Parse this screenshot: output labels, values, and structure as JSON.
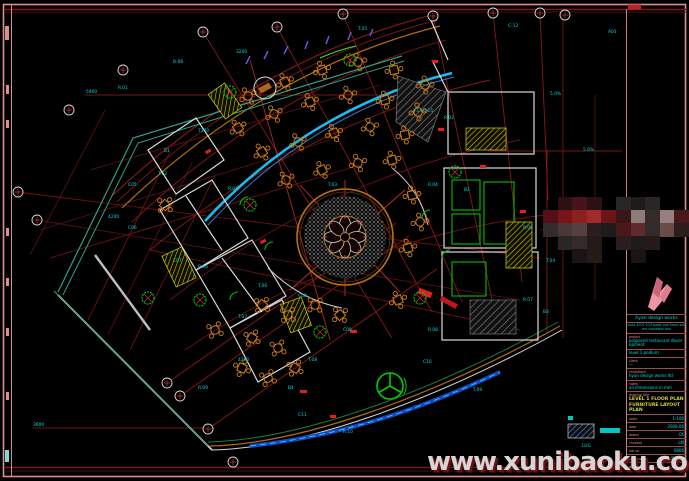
{
  "colors": {
    "frame": "#d98f8f",
    "frame_dark": "#7a1a1a",
    "grid_red": "#8a1818",
    "grid_bright": "#c03030",
    "cyan_text": "#00dcdc",
    "arc_cyan": "#18bdf0",
    "teal": "#2fa08a",
    "furniture": "#cf7f16",
    "wall_white": "#d8d8d8",
    "green": "#00c000",
    "stair_yellow": "#d8d800",
    "blue_band": "#1546c8",
    "logo_pink": "#ef94a2"
  },
  "watermark": {
    "text": "www.xunibaoku.com"
  },
  "title_block": {
    "caption": "hyan design works",
    "address": "suite 2001 20/f tower one times square causeway bay",
    "rows": [
      {
        "label": "project",
        "value": "proposed restaurant development"
      },
      {
        "label": "",
        "value": "level 1 podium"
      },
      {
        "label": "client",
        "value": "—"
      },
      {
        "label": "consultant",
        "value": "hyan design works ltd"
      },
      {
        "label": "notes",
        "value": "all dimensions in mm"
      }
    ],
    "title_label": "drawing title",
    "drawing_title": "LEVEL 1 FLOOR PLAN FURNITURE LAYOUT PLAN",
    "fields": [
      {
        "label": "scale",
        "value": "1:100"
      },
      {
        "label": "date",
        "value": "2008.06"
      },
      {
        "label": "drawn",
        "value": "CK"
      },
      {
        "label": "checked",
        "value": "LM"
      },
      {
        "label": "job no.",
        "value": "0806"
      },
      {
        "label": "drawing no.",
        "value": "ID-101"
      },
      {
        "label": "rev",
        "value": "A"
      }
    ]
  },
  "legend": {
    "swatch_label": "P.01"
  },
  "plan": {
    "labels": [
      {
        "t": "5400",
        "x": 86,
        "y": 93
      },
      {
        "t": "3600",
        "x": 33,
        "y": 426
      },
      {
        "t": "T.05",
        "x": 358,
        "y": 30
      },
      {
        "t": "C-12",
        "x": 508,
        "y": 27
      },
      {
        "t": "A01",
        "x": 608,
        "y": 33
      },
      {
        "t": "3200",
        "x": 236,
        "y": 53
      },
      {
        "t": "B-06",
        "x": 173,
        "y": 63
      },
      {
        "t": "R.01",
        "x": 118,
        "y": 89
      },
      {
        "t": "5.0%",
        "x": 550,
        "y": 95
      },
      {
        "t": "F.L+0.15",
        "x": 414,
        "y": 112
      },
      {
        "t": "R.02",
        "x": 444,
        "y": 119
      },
      {
        "t": "7200",
        "x": 198,
        "y": 132
      },
      {
        "t": "B1",
        "x": 164,
        "y": 152
      },
      {
        "t": "5.0%",
        "x": 583,
        "y": 151
      },
      {
        "t": "T.02",
        "x": 158,
        "y": 175
      },
      {
        "t": "C05",
        "x": 128,
        "y": 186
      },
      {
        "t": "R.03",
        "x": 228,
        "y": 190
      },
      {
        "t": "T.03",
        "x": 328,
        "y": 186
      },
      {
        "t": "R.04",
        "x": 428,
        "y": 186
      },
      {
        "t": "B2",
        "x": 464,
        "y": 191
      },
      {
        "t": "4200",
        "x": 108,
        "y": 218
      },
      {
        "t": "C06",
        "x": 128,
        "y": 229
      },
      {
        "t": "R.05",
        "x": 523,
        "y": 229
      },
      {
        "t": "T.04",
        "x": 546,
        "y": 262
      },
      {
        "t": "C07",
        "x": 173,
        "y": 262
      },
      {
        "t": "R.06",
        "x": 198,
        "y": 268
      },
      {
        "t": "T.06",
        "x": 258,
        "y": 287
      },
      {
        "t": "C08",
        "x": 298,
        "y": 297
      },
      {
        "t": "R.07",
        "x": 523,
        "y": 301
      },
      {
        "t": "B3",
        "x": 543,
        "y": 313
      },
      {
        "t": "T.07",
        "x": 238,
        "y": 318
      },
      {
        "t": "C09",
        "x": 343,
        "y": 331
      },
      {
        "t": "R.08",
        "x": 428,
        "y": 331
      },
      {
        "t": "4200",
        "x": 238,
        "y": 361
      },
      {
        "t": "T.08",
        "x": 308,
        "y": 361
      },
      {
        "t": "C10",
        "x": 423,
        "y": 363
      },
      {
        "t": "R.09",
        "x": 198,
        "y": 389
      },
      {
        "t": "B4",
        "x": 288,
        "y": 389
      },
      {
        "t": "T.09",
        "x": 473,
        "y": 391
      },
      {
        "t": "C11",
        "x": 298,
        "y": 416
      },
      {
        "t": "R.10",
        "x": 343,
        "y": 433
      },
      {
        "t": "LUG",
        "x": 582,
        "y": 447
      }
    ]
  },
  "censor": {
    "palette": [
      "#541016",
      "#7a1418",
      "#8c1f1f",
      "#a12a2a",
      "#6b1518",
      "#3a1416",
      "#8d7a7a",
      "#342a2a",
      "#957f7f",
      "#4a1818",
      "#2a1214",
      "#461418",
      "#2b2626",
      "#1f1b1b",
      "#4a3838",
      "#553f3f",
      "#2b1d1d",
      "#5f2a2a",
      "#6b4a4a",
      "#241a1a",
      "#1c1414"
    ]
  }
}
